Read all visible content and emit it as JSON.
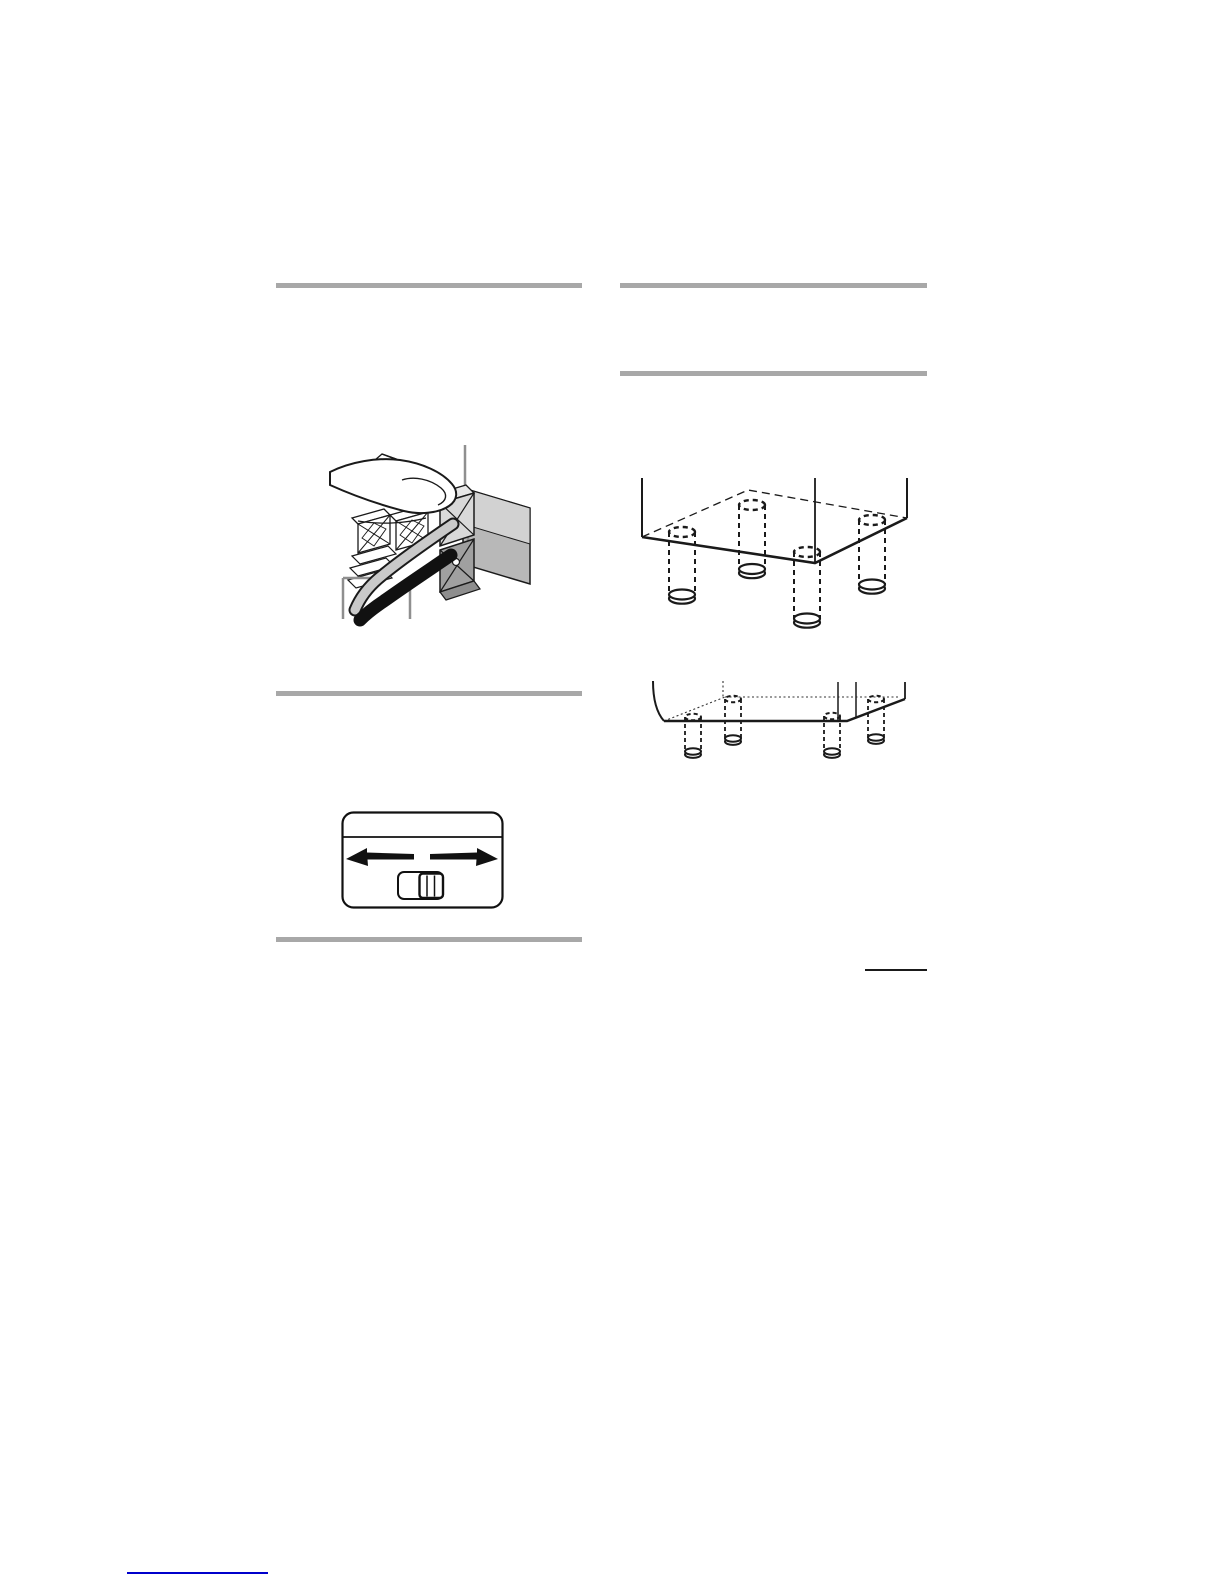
{
  "page": {
    "kind": "manual-page",
    "background": "#ffffff",
    "width": 1225,
    "height": 1585
  },
  "colors": {
    "rule_gray": "#a8a8a8",
    "callout_gray": "#8f8f8f",
    "line_black": "#1a1a1a",
    "link_blue": "#0000cc",
    "shade_light": "#d9d9d9",
    "shade_mid": "#b8b8b8",
    "shade_dark": "#9e9e9e",
    "cord_gray": "#c9c9c9"
  },
  "figures": {
    "terminal": {
      "label": "speaker-terminal-cord-insertion-illustration"
    },
    "switch": {
      "label": "slider-switch-illustration"
    },
    "bottom_large": {
      "label": "speaker-bottom-with-four-feet-illustration"
    },
    "bottom_small": {
      "label": "speaker-bottom-with-four-small-feet-illustration"
    }
  },
  "footer": {
    "link": {
      "text": ""
    }
  }
}
